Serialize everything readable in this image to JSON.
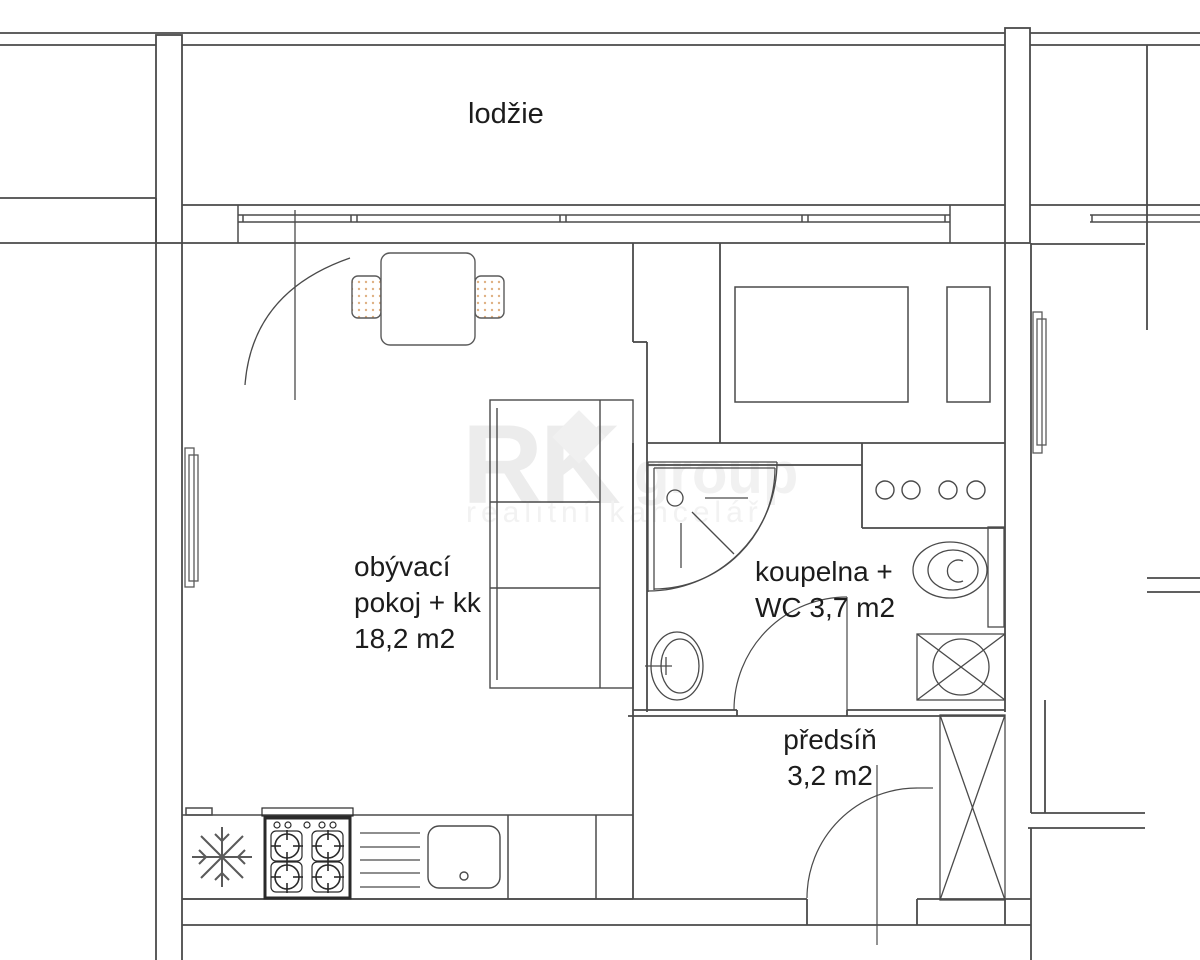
{
  "plan_title": "studio apartment floor plan",
  "rooms": {
    "loggia": {
      "label": "lodžie"
    },
    "living": {
      "line1": "obývací",
      "line2": "pokoj + kk",
      "line3": "18,2 m2"
    },
    "bathroom": {
      "line1": "koupelna +",
      "line2": "WC 3,7 m2"
    },
    "hall": {
      "line1": "předsíň",
      "line2": "3,2 m2"
    }
  },
  "watermark": {
    "brand": "RK",
    "brand_suffix": "group",
    "tagline": "realitní kancelář"
  },
  "colors": {
    "line": "#4a4a4a",
    "chair_dot": "#dfb183",
    "watermark_gray": "#ededed",
    "text": "#1c1c1c"
  },
  "symbols": {
    "fridge": "snowflake-icon",
    "stove": "four-burner-stove-icon",
    "sink": "kitchen-sink-icon",
    "drainboard": "drainboard-lines-icon",
    "shower": "corner-shower-icon",
    "washbasin": "washbasin-icon",
    "toilet": "toilet-icon",
    "washing_machine": "washing-machine-icon",
    "wardrobe": "wardrobe-x-icon",
    "bed": "bed-icon",
    "sofa": "sofa-icon",
    "table": "dining-table-icon",
    "chair": "chair-icon",
    "radiator": "radiator-icon"
  }
}
